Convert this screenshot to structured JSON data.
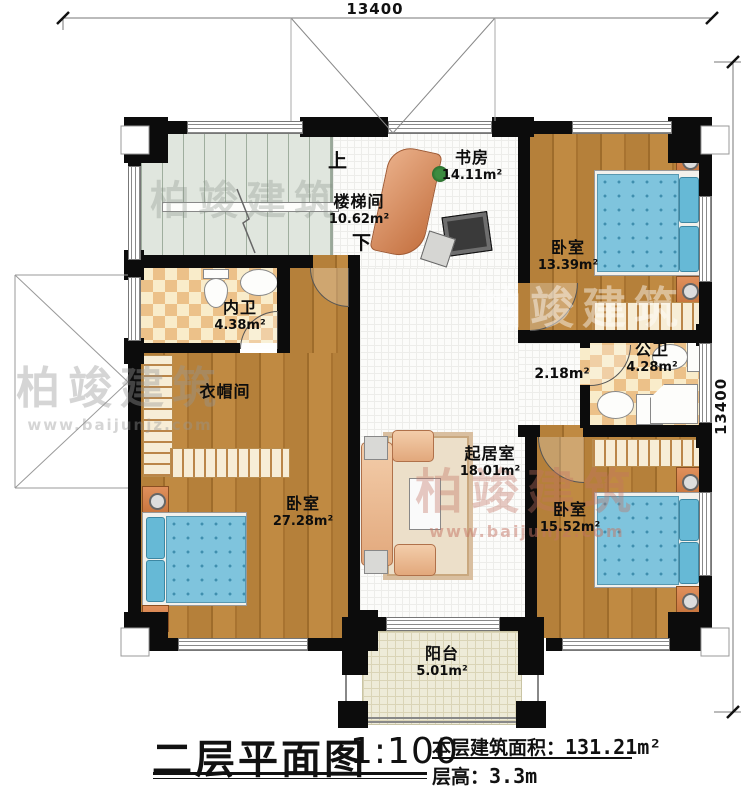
{
  "plan": {
    "title": "二层平面图",
    "scale": "1:100",
    "area_label": "本层建筑面积：",
    "area_value": "131.21m²",
    "height_label": "层高：",
    "height_value": "3.3m",
    "dim_top": "13400",
    "dim_right": "13400"
  },
  "stairs": {
    "up": "上",
    "down": "下"
  },
  "rooms": {
    "stairwell": {
      "name": "楼梯间",
      "area": "10.62m²"
    },
    "study": {
      "name": "书房",
      "area": "14.11m²"
    },
    "bedroom_ne": {
      "name": "卧室",
      "area": "13.39m²"
    },
    "inner_bath": {
      "name": "内卫",
      "area": "4.38m²"
    },
    "closet": {
      "name": "衣帽间"
    },
    "hallway": {
      "area": "2.18m²"
    },
    "public_bath": {
      "name": "公卫",
      "area": "4.28m²"
    },
    "living": {
      "name": "起居室",
      "area": "18.01m²"
    },
    "bedroom_sw": {
      "name": "卧室",
      "area": "27.28m²"
    },
    "bedroom_se": {
      "name": "卧室",
      "area": "15.52m²"
    },
    "balcony": {
      "name": "阳台",
      "area": "5.01m²"
    }
  },
  "watermark": {
    "brand": "柏竣建筑",
    "url": "www.baijunjz.com"
  },
  "colors": {
    "wall": "#0c0c0c",
    "wood_floor": "#b5803a",
    "bath_tile": "#ecc189",
    "mattress": "#7fc4dd",
    "stair_floor": "#e0e6de",
    "balcony_floor": "#eeebd8",
    "furniture_accent": "#d98b57"
  }
}
